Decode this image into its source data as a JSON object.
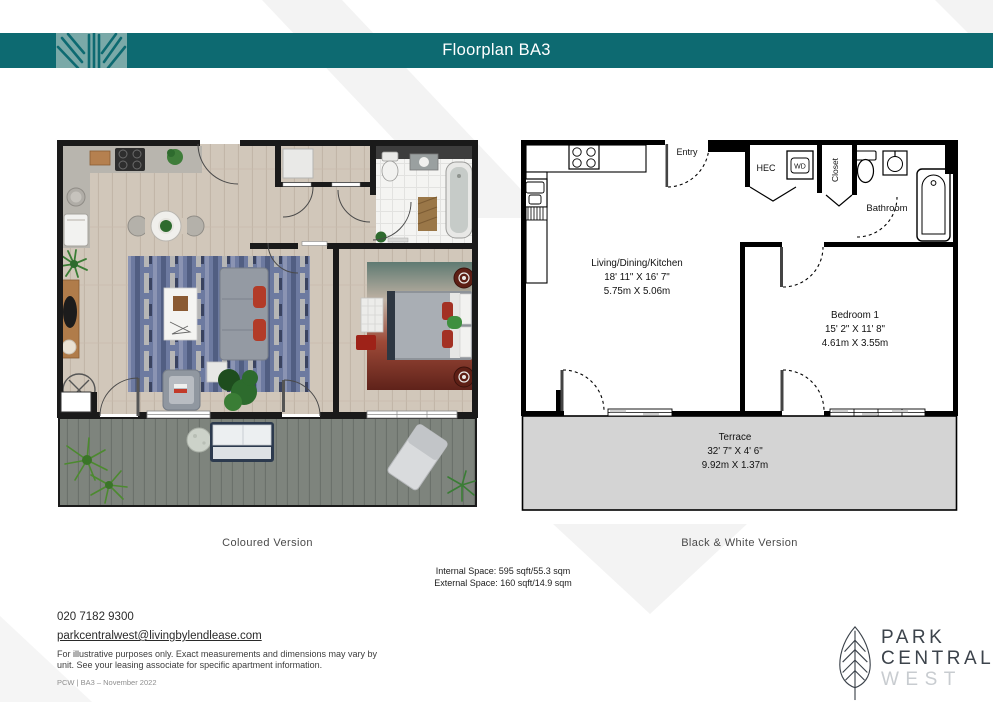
{
  "header": {
    "title": "Floorplan BA3"
  },
  "captions": {
    "coloured": "Coloured Version",
    "bw": "Black & White Version"
  },
  "space": {
    "internal": "Internal Space: 595 sqft/55.3 sqm",
    "external": "External Space: 160 sqft/14.9 sqm"
  },
  "plan": {
    "entry": "Entry",
    "hec": "HEC",
    "wd": "WD",
    "closet": "Closet",
    "bathroom": "Bathroom",
    "living": {
      "name": "Living/Dining/Kitchen",
      "imperial": "18' 11\" X 16' 7\"",
      "metric": "5.75m X 5.06m"
    },
    "bedroom": {
      "name": "Bedroom 1",
      "imperial": "15' 2\" X 11' 8\"",
      "metric": "4.61m X 3.55m"
    },
    "terrace": {
      "name": "Terrace",
      "imperial": "32' 7\" X 4' 6\"",
      "metric": "9.92m X 1.37m"
    }
  },
  "contact": {
    "phone": "020 7182 9300",
    "email": "parkcentralwest@livingbylendlease.com",
    "disclaimer1": "For illustrative purposes only. Exact measurements and dimensions may vary by",
    "disclaimer2": "unit.  See your leasing associate for specific apartment information.",
    "ref": "PCW | BA3 – November  2022"
  },
  "brand": {
    "park": "PARK",
    "central": "CENTRAL",
    "west": "WEST"
  },
  "colors": {
    "teal": "#0d6a71",
    "teal_light": "#7aa9a8",
    "terrace_gray": "#d4d4d4",
    "wall_black": "#1a1a1a",
    "wood_floor": "#d1c7ba",
    "deck_gray": "#7e847d"
  }
}
